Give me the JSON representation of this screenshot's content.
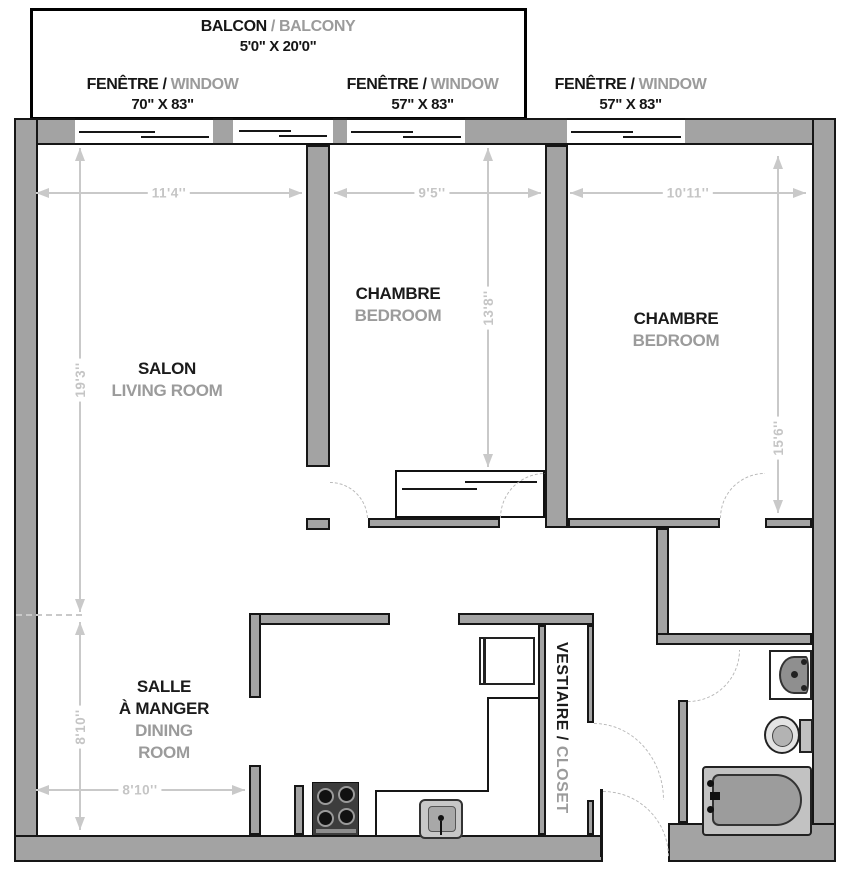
{
  "balcony": {
    "fr": "BALCON",
    "sep": "/",
    "en": "BALCONY",
    "size": "5'0\" X 20'0\""
  },
  "window_labels": [
    {
      "fr": "FENÊTRE",
      "sep": "/",
      "en": "WINDOW",
      "size": "70\" X 83\""
    },
    {
      "fr": "FENÊTRE",
      "sep": "/",
      "en": "WINDOW",
      "size": "57\" X 83\""
    },
    {
      "fr": "FENÊTRE",
      "sep": "/",
      "en": "WINDOW",
      "size": "57\" X 83\""
    }
  ],
  "rooms": {
    "living": {
      "fr": "SALON",
      "en": "LIVING ROOM"
    },
    "bedroom_mid": {
      "fr": "CHAMBRE",
      "en": "BEDROOM"
    },
    "bedroom_right": {
      "fr": "CHAMBRE",
      "en": "BEDROOM"
    },
    "dining": {
      "fr_line1": "SALLE",
      "fr_line2": "À MANGER",
      "en_line1": "DINING",
      "en_line2": "ROOM"
    },
    "closet": {
      "fr": "VESTIAIRE /",
      "en": "CLOSET"
    }
  },
  "dims": {
    "living_w": "11'4''",
    "living_l": "19'3''",
    "bed1_w": "9'5''",
    "bed1_l": "13'8''",
    "bed2_w": "10'11''",
    "bed2_l": "15'6''",
    "dining_w": "8'10''",
    "dining_l": "8'10''"
  },
  "colors": {
    "wall_fill": "#a3a3a3",
    "outline": "#161616",
    "dimension": "#c9c9c9",
    "label_primary": "#1b1b1b",
    "label_secondary": "#9b9b9b"
  }
}
